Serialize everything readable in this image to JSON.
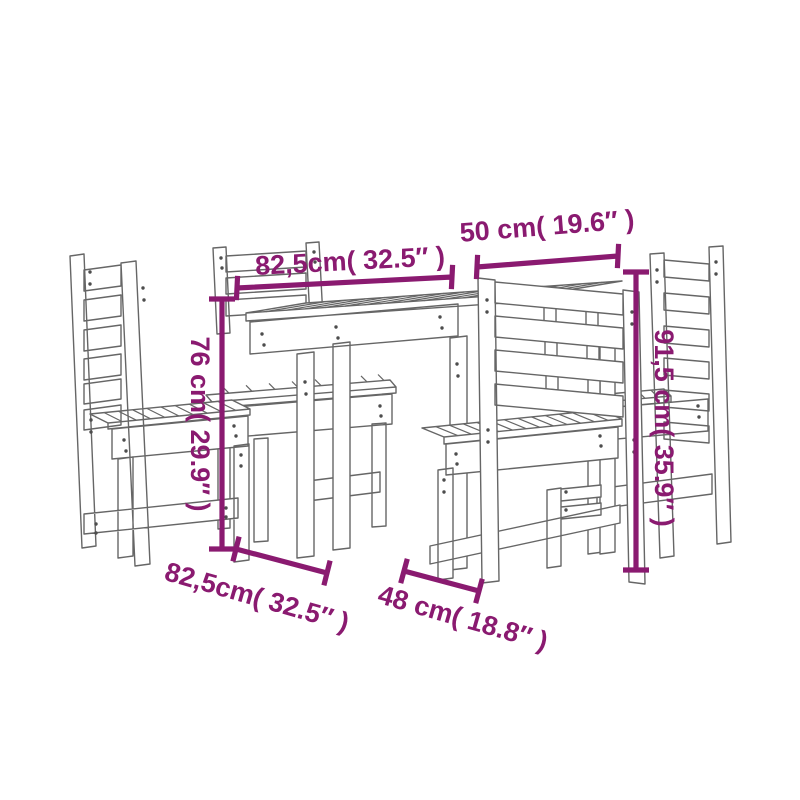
{
  "diagram": {
    "type": "product-dimension-drawing",
    "subject": "garden dining set: slatted table with four slat-back chairs",
    "background_color": "#ffffff",
    "line_color": "#666666",
    "dimension_color": "#8a1a70",
    "dimensions": {
      "tabletop_length_top": "82,5cm( 32.5″ )",
      "tabletop_depth_top": "50 cm( 19.6″ )",
      "table_height_left": "76 cm( 29.9″ )",
      "chair_height_right": "91,5 cm( 35.9″ )",
      "chair_depth_bottom": "82,5cm( 32.5″ )",
      "chair_width_bottom": "48 cm( 18.8″ )"
    }
  }
}
